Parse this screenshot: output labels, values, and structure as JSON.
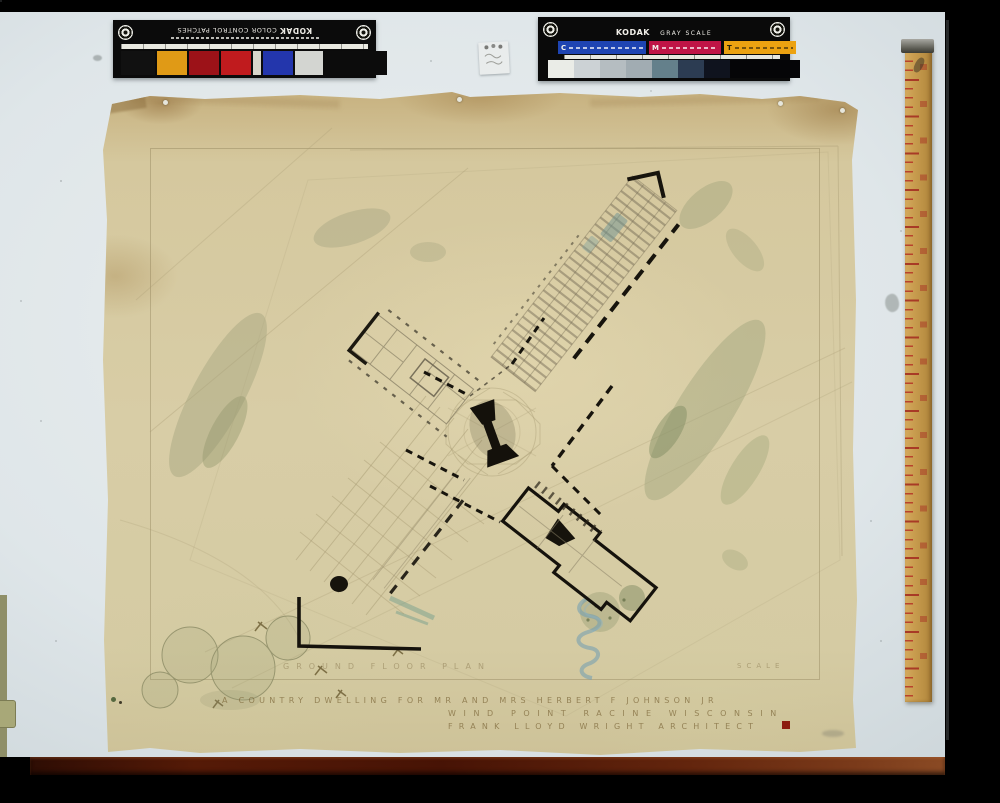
{
  "calibration": {
    "color_patches": {
      "brand": "KODAK",
      "label": "COLOR CONTROL PATCHES",
      "patches": [
        {
          "c": "#111111",
          "w": 34
        },
        {
          "c": "#e09a16",
          "w": 30
        },
        {
          "c": "#9c1218",
          "w": 30
        },
        {
          "c": "#c01b1e",
          "w": 30
        },
        {
          "c": "#d8d6cb",
          "w": 8
        },
        {
          "c": "#2336ac",
          "w": 30
        },
        {
          "c": "#d3d5d1",
          "w": 28
        },
        {
          "c": "#0c0c0c",
          "w": 62
        }
      ]
    },
    "gray_scale": {
      "brand": "KODAK",
      "label": "GRAY SCALE",
      "bands": [
        {
          "letter": "C",
          "color": "#1e44b2",
          "w": 82
        },
        {
          "letter": "M",
          "color": "#bf1446",
          "w": 66
        },
        {
          "letter": "T",
          "color": "#eca211",
          "w": 66,
          "dark_text": true
        }
      ],
      "steps": [
        {
          "c": "#eaece7",
          "w": 26
        },
        {
          "c": "#ccd2d5",
          "w": 26
        },
        {
          "c": "#b5bdc1",
          "w": 26
        },
        {
          "c": "#a1acb2",
          "w": 26
        },
        {
          "c": "#64808b",
          "w": 26
        },
        {
          "c": "#2c3c52",
          "w": 26
        },
        {
          "c": "#0f131e",
          "w": 26
        },
        {
          "c": "#050507",
          "w": 70
        }
      ]
    }
  },
  "sheet": {
    "plan_label": "GROUND FLOOR PLAN",
    "scale_label": "SCALE",
    "title_line1": "A COUNTRY DWELLING FOR MR AND MRS HERBERT F JOHNSON JR",
    "title_line2": "WIND POINT RACINE WISCONSIN",
    "title_line3": "FRANK LLOYD WRIGHT ARCHITECT",
    "accent_square_color": "#8c1d10",
    "paper_color": "#d8cda6"
  },
  "props": {
    "ruler": "wooden yardstick",
    "backdrop_color": "#dfe6e9",
    "table_edge_color": "#551a07"
  }
}
